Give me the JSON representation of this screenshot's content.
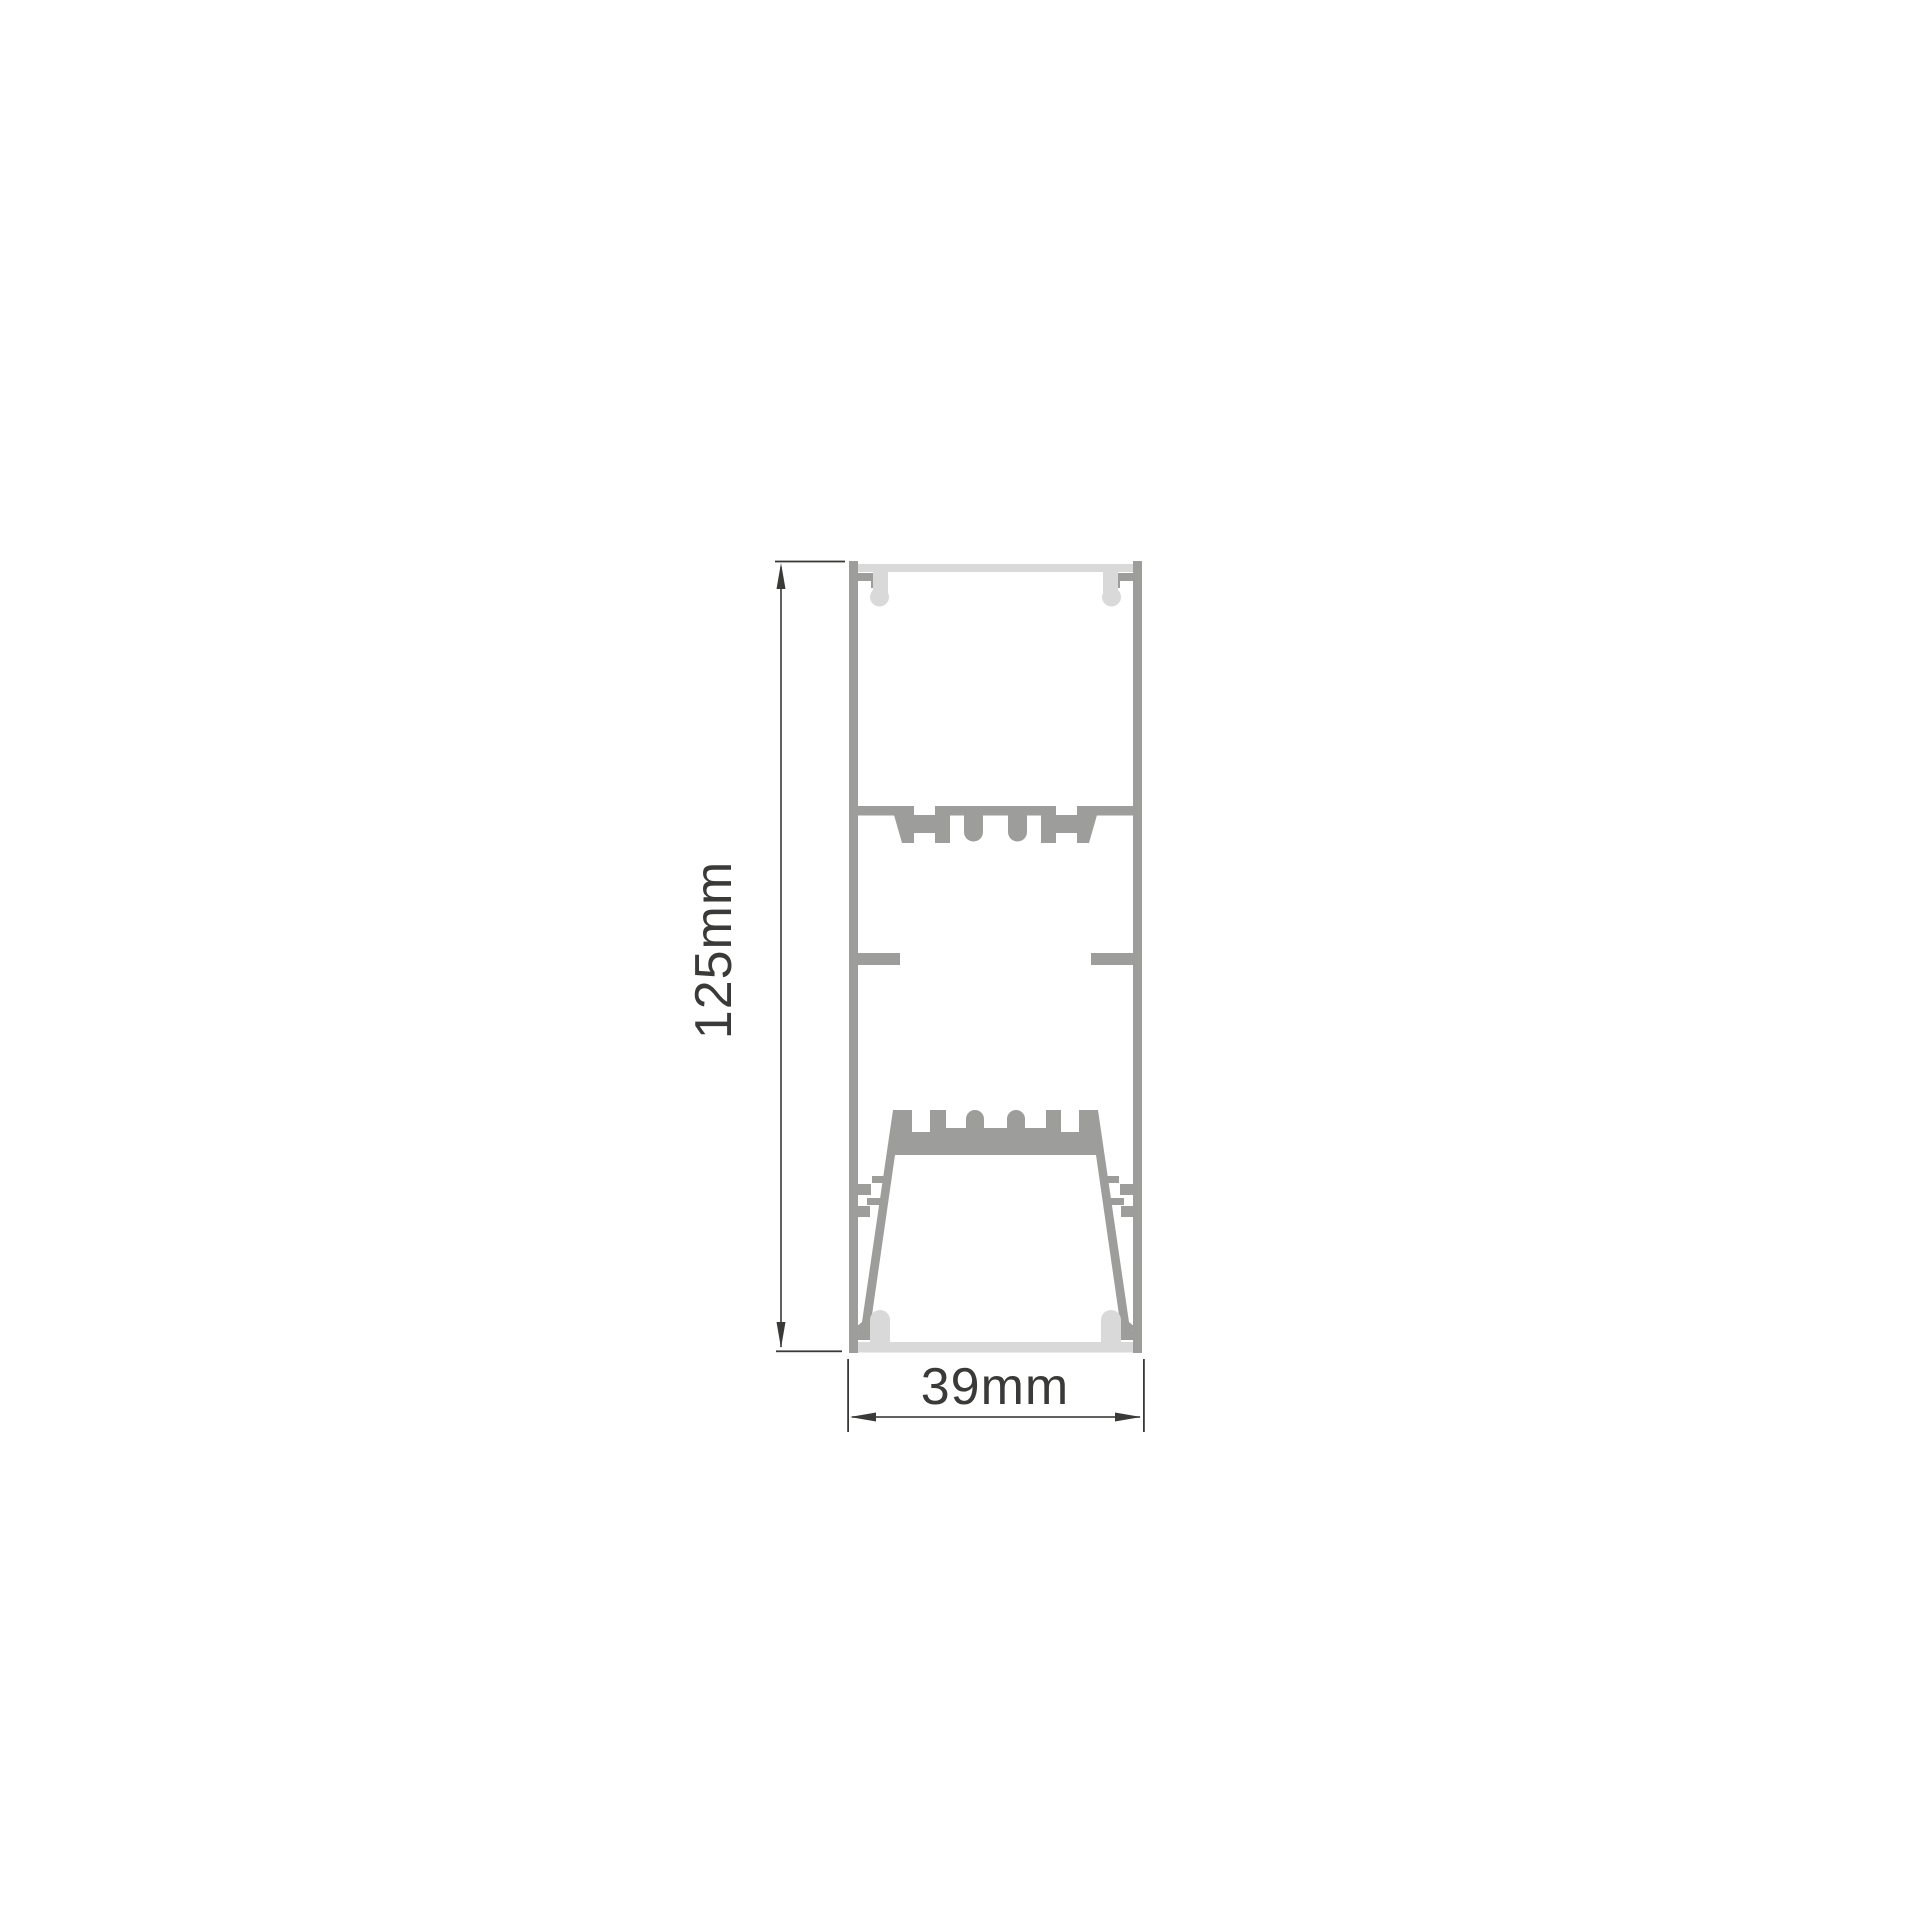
{
  "page": {
    "background": "#ffffff"
  },
  "colors": {
    "aluminum": "#9d9d9c",
    "diffuser": "#d9d9d9",
    "dimension": "#3a3a39"
  },
  "drawing": {
    "description": "Cross-section technical drawing of a rectangular dual-chamber linear profile with top and bottom diffusers",
    "dimensions": {
      "height": {
        "label": "125mm"
      },
      "width": {
        "label": "39mm"
      }
    }
  }
}
